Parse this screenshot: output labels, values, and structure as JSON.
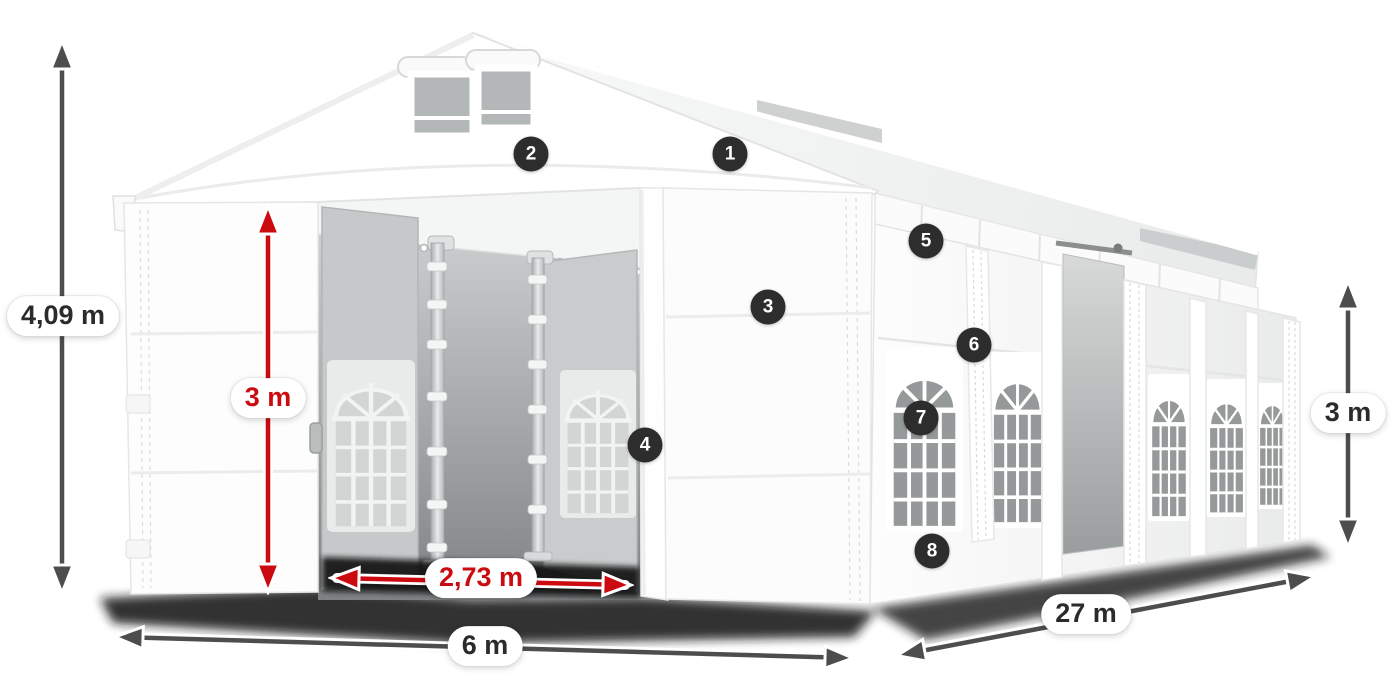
{
  "illustration": {
    "subject": "white party tent / marquee with open double entrance, side windows and numbered part callouts",
    "tent_color": "#ffffff",
    "interior_gray": "#9fa3a4",
    "window_glass_gray": "#96999a"
  },
  "dimensions": {
    "total_height": "4,09 m",
    "entrance_inner_height": "3 m",
    "entrance_width": "2,73 m",
    "tent_width": "6 m",
    "tent_length": "27 m",
    "side_wall_height": "3 m"
  },
  "callouts": [
    {
      "number": "1"
    },
    {
      "number": "2"
    },
    {
      "number": "3"
    },
    {
      "number": "4"
    },
    {
      "number": "5"
    },
    {
      "number": "6"
    },
    {
      "number": "7"
    },
    {
      "number": "8"
    }
  ],
  "colors": {
    "dimension_red": "#cc0b10",
    "dimension_gray": "#4d4d4d",
    "badge_background": "#2d2d2d",
    "badge_text": "#ffffff",
    "label_dark_text": "#2b2b2b",
    "canvas_background": "#ffffff"
  }
}
